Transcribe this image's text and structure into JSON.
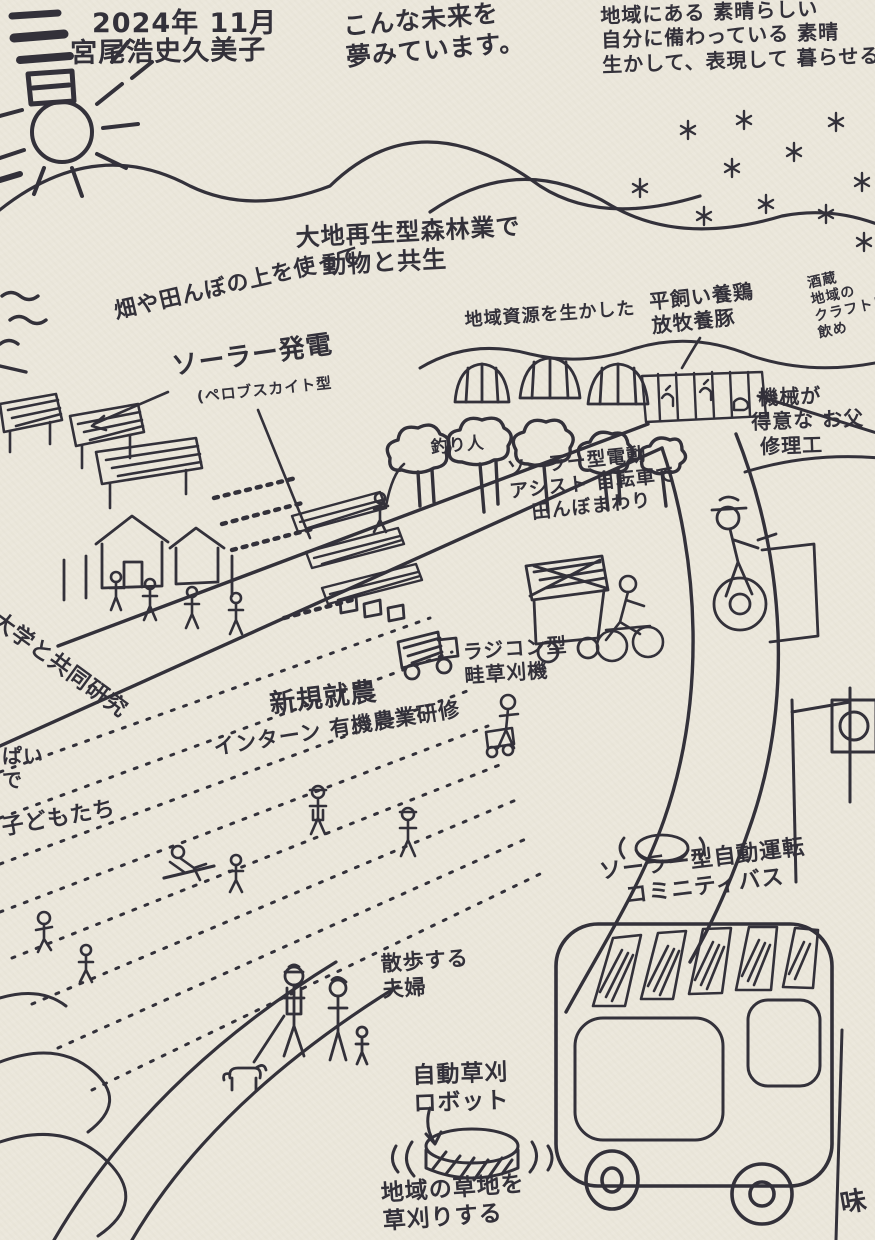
{
  "scene": {
    "kind": "hand-drawn community future vision map",
    "paper_color": "#ebe7db",
    "ink_color": "#33313a"
  },
  "annotations": [
    {
      "id": "date",
      "text": "2024年 11月",
      "x": 92,
      "y": 8,
      "size": 27,
      "rotate": 0
    },
    {
      "id": "author-names",
      "text": "宮尾浩史久美子",
      "x": 70,
      "y": 38,
      "size": 27,
      "rotate": -1
    },
    {
      "id": "dream-statement",
      "text": "こんな未来を\n夢みています。",
      "x": 342,
      "y": 12,
      "size": 25,
      "rotate": -5
    },
    {
      "id": "vision-statement",
      "text": "地域にある 素晴らしい\n自分に備わっている 素晴\n生かして、表現して 暮らせる",
      "x": 600,
      "y": 4,
      "size": 20,
      "rotate": -2
    },
    {
      "id": "forestry-label",
      "text": "大地再生型森林業で\n　動物と共生",
      "x": 295,
      "y": 224,
      "size": 24,
      "rotate": -3
    },
    {
      "id": "solar-over-fields-label",
      "text": "畑や田んぼの上を使って",
      "x": 112,
      "y": 300,
      "size": 22,
      "rotate": -13
    },
    {
      "id": "solar-power-label",
      "text": "ソーラー発電",
      "x": 170,
      "y": 352,
      "size": 26,
      "rotate": -8
    },
    {
      "id": "perovskite-label",
      "text": "(ペロブスカイト型",
      "x": 196,
      "y": 388,
      "size": 15,
      "rotate": -6
    },
    {
      "id": "local-resources-label",
      "text": "地域資源を生かした",
      "x": 464,
      "y": 310,
      "size": 18,
      "rotate": -4
    },
    {
      "id": "poultry-label",
      "text": "平飼い養鶏\n放牧養豚",
      "x": 648,
      "y": 290,
      "size": 20,
      "rotate": -6
    },
    {
      "id": "sake-brewery-label",
      "text": "酒蔵\n地域の\nクラフトビール\n飲め",
      "x": 806,
      "y": 276,
      "size": 14,
      "rotate": -12
    },
    {
      "id": "repair-shop-label",
      "text": " 機械が\n得意な お父\n 修理工",
      "x": 750,
      "y": 386,
      "size": 20,
      "rotate": -2
    },
    {
      "id": "angler-label",
      "text": "釣り人",
      "x": 430,
      "y": 438,
      "size": 17,
      "rotate": -5
    },
    {
      "id": "ebike-label",
      "text": "ソーラー型電動\nアシスト 自転車で\n　田んぼまわり",
      "x": 506,
      "y": 458,
      "size": 19,
      "rotate": -6
    },
    {
      "id": "rc-mower-label",
      "text": "ラジコン型\n畦草刈機",
      "x": 462,
      "y": 640,
      "size": 20,
      "rotate": -4
    },
    {
      "id": "university-label",
      "text": "大学と共同研究",
      "x": 2,
      "y": 608,
      "size": 22,
      "rotate": 36
    },
    {
      "id": "new-farmers-label",
      "text": "新規就農",
      "x": 268,
      "y": 690,
      "size": 26,
      "rotate": -7
    },
    {
      "id": "intern-label",
      "text": "インターン 有機農業研修",
      "x": 212,
      "y": 736,
      "size": 21,
      "rotate": -9
    },
    {
      "id": "left-edge-fragment",
      "text": "ぱい\nで",
      "x": 2,
      "y": 744,
      "size": 20,
      "rotate": 0
    },
    {
      "id": "children-label",
      "text": "子どもたち",
      "x": 0,
      "y": 816,
      "size": 22,
      "rotate": -10
    },
    {
      "id": "strolling-couple-label",
      "text": "散歩する\n夫婦",
      "x": 380,
      "y": 952,
      "size": 21,
      "rotate": -4
    },
    {
      "id": "autonomous-bus-label",
      "text": "ソーラー型自動運転\n　コミニティバス",
      "x": 598,
      "y": 860,
      "size": 22,
      "rotate": -7
    },
    {
      "id": "mowing-robot-label",
      "text": "自動草刈\nロボット",
      "x": 412,
      "y": 1062,
      "size": 23,
      "rotate": -2
    },
    {
      "id": "mowing-note-label",
      "text": "地域の草地を\n草刈りする",
      "x": 380,
      "y": 1180,
      "size": 23,
      "rotate": -4
    },
    {
      "id": "taste-fragment",
      "text": "味",
      "x": 838,
      "y": 1190,
      "size": 26,
      "rotate": -10
    }
  ]
}
